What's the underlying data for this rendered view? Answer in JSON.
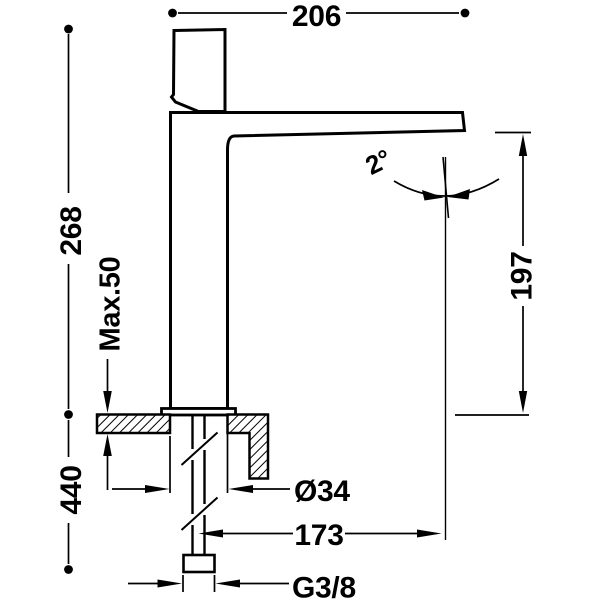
{
  "drawing": {
    "labels": {
      "spout_width": "206",
      "height_above_deck": "268",
      "max_deck_thickness": "Max.50",
      "total_height": "440",
      "spout_tilt_angle": "2°",
      "outlet_height": "197",
      "body_diameter": "Ø34",
      "spout_projection": "173",
      "supply_thread": "G3/8"
    },
    "colors": {
      "line": "#000000",
      "background": "#ffffff"
    }
  }
}
